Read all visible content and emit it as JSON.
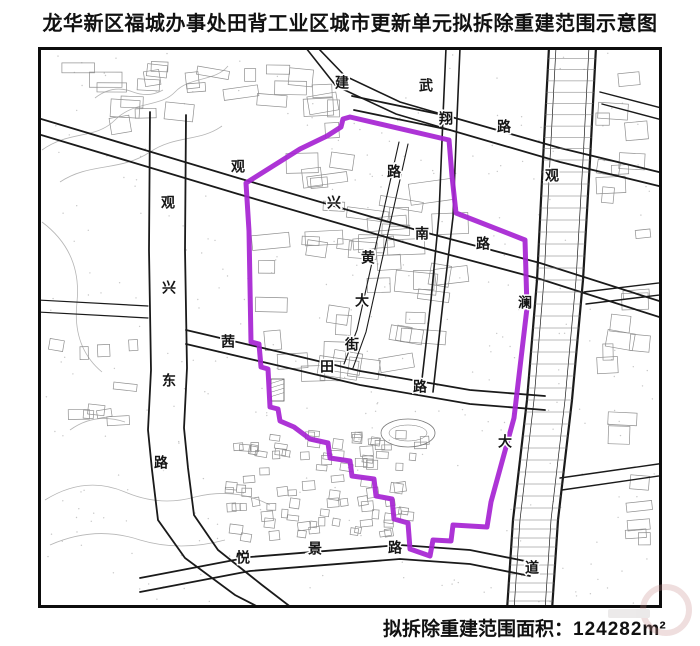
{
  "title": "龙华新区福城办事处田背工业区城市更新单元拟拆除重建范围示意图",
  "caption": {
    "label": "拟拆除重建范围面积：",
    "value": "124282",
    "unit": "m²"
  },
  "map": {
    "colors": {
      "ink": "#1a1a1a",
      "building": "#8f8f8f",
      "contour": "#b5b5b5",
      "speckle": "#9a9a9a",
      "boundary": "#a623d3"
    },
    "boundary_points": [
      [
        350,
        117
      ],
      [
        449,
        140
      ],
      [
        452,
        176
      ],
      [
        456,
        213
      ],
      [
        525,
        240
      ],
      [
        527,
        308
      ],
      [
        514,
        418
      ],
      [
        491,
        502
      ],
      [
        487,
        527
      ],
      [
        453,
        525
      ],
      [
        451,
        541
      ],
      [
        433,
        540
      ],
      [
        430,
        556
      ],
      [
        410,
        549
      ],
      [
        408,
        523
      ],
      [
        394,
        519
      ],
      [
        392,
        499
      ],
      [
        376,
        496
      ],
      [
        374,
        479
      ],
      [
        352,
        476
      ],
      [
        350,
        461
      ],
      [
        330,
        458
      ],
      [
        328,
        443
      ],
      [
        310,
        439
      ],
      [
        294,
        427
      ],
      [
        280,
        421
      ],
      [
        278,
        409
      ],
      [
        270,
        407
      ],
      [
        268,
        369
      ],
      [
        261,
        367
      ],
      [
        259,
        344
      ],
      [
        251,
        342
      ],
      [
        249,
        231
      ],
      [
        246,
        183
      ],
      [
        300,
        149
      ],
      [
        327,
        136
      ],
      [
        341,
        127
      ],
      [
        343,
        119
      ]
    ],
    "roads": [
      {
        "name": "guanxing-east-road",
        "w": 1.8,
        "lines": [
          [
            [
              150,
              112
            ],
            [
              149,
              250
            ],
            [
              151,
              370
            ],
            [
              148,
              430
            ],
            [
              152,
              470
            ],
            [
              158,
              520
            ],
            [
              185,
              558
            ],
            [
              235,
              595
            ],
            [
              268,
              612
            ]
          ],
          [
            [
              186,
              115
            ],
            [
              185,
              250
            ],
            [
              187,
              368
            ],
            [
              184,
              428
            ],
            [
              188,
              468
            ],
            [
              194,
              515
            ],
            [
              218,
              550
            ],
            [
              262,
              585
            ],
            [
              292,
              608
            ]
          ]
        ]
      },
      {
        "name": "guanxing-south-road",
        "w": 1.8,
        "lines": [
          [
            [
              38,
              118
            ],
            [
              238,
              178
            ],
            [
              420,
              231
            ],
            [
              540,
              263
            ],
            [
              700,
              314
            ]
          ],
          [
            [
              38,
              134
            ],
            [
              238,
              194
            ],
            [
              420,
              247
            ],
            [
              540,
              279
            ],
            [
              700,
              330
            ]
          ]
        ]
      },
      {
        "name": "wuxiang-road",
        "w": 1.8,
        "lines": [
          [
            [
              352,
              96
            ],
            [
              448,
              116
            ],
            [
              560,
              148
            ],
            [
              700,
              182
            ]
          ],
          [
            [
              354,
              110
            ],
            [
              450,
              130
            ],
            [
              560,
              162
            ],
            [
              700,
              196
            ]
          ]
        ]
      },
      {
        "name": "jian-road",
        "w": 1.6,
        "lines": [
          [
            [
              318,
              48
            ],
            [
              345,
              76
            ],
            [
              400,
              102
            ],
            [
              448,
              116
            ]
          ],
          [
            [
              306,
              48
            ],
            [
              336,
              86
            ],
            [
              396,
              114
            ],
            [
              450,
              130
            ]
          ]
        ]
      },
      {
        "name": "north-south-road",
        "w": 1.6,
        "lines": [
          [
            [
              446,
              48
            ],
            [
              443,
              116
            ],
            [
              439,
              215
            ],
            [
              431,
              300
            ],
            [
              421,
              388
            ]
          ],
          [
            [
              460,
              48
            ],
            [
              457,
              118
            ],
            [
              453,
              217
            ],
            [
              443,
              302
            ],
            [
              433,
              392
            ]
          ]
        ]
      },
      {
        "name": "huang-street",
        "w": 1.1,
        "lines": [
          [
            [
              399,
              142
            ],
            [
              377,
              240
            ],
            [
              357,
              330
            ],
            [
              344,
              364
            ]
          ],
          [
            [
              408,
              144
            ],
            [
              386,
              242
            ],
            [
              366,
              332
            ],
            [
              353,
              368
            ]
          ]
        ]
      },
      {
        "name": "qiantian-road",
        "w": 1.8,
        "lines": [
          [
            [
              186,
              330
            ],
            [
              280,
              352
            ],
            [
              360,
              371
            ],
            [
              470,
              390
            ],
            [
              545,
              396
            ]
          ],
          [
            [
              186,
              344
            ],
            [
              280,
              366
            ],
            [
              360,
              385
            ],
            [
              470,
              404
            ],
            [
              545,
              410
            ]
          ]
        ]
      },
      {
        "name": "guanlan-avenue",
        "w": 2.2,
        "hatch": true,
        "lines": [
          [
            [
              549,
              47
            ],
            [
              543,
              160
            ],
            [
              537,
              280
            ],
            [
              527,
              400
            ],
            [
              513,
              520
            ],
            [
              507,
              610
            ]
          ],
          [
            [
              596,
              47
            ],
            [
              590,
              160
            ],
            [
              583,
              280
            ],
            [
              572,
              400
            ],
            [
              558,
              520
            ],
            [
              552,
              610
            ]
          ],
          [
            [
              556,
              47
            ],
            [
              550,
              160
            ],
            [
              544,
              280
            ],
            [
              534,
              400
            ],
            [
              520,
              520
            ],
            [
              514,
              610
            ]
          ],
          [
            [
              589,
              47
            ],
            [
              583,
              160
            ],
            [
              576,
              280
            ],
            [
              565,
              400
            ],
            [
              551,
              520
            ],
            [
              545,
              610
            ]
          ]
        ]
      },
      {
        "name": "yuejing-road",
        "w": 1.8,
        "lines": [
          [
            [
              140,
              578
            ],
            [
              250,
              557
            ],
            [
              400,
              545
            ],
            [
              470,
              550
            ],
            [
              530,
              562
            ]
          ],
          [
            [
              140,
              592
            ],
            [
              250,
              571
            ],
            [
              400,
              559
            ],
            [
              470,
              564
            ],
            [
              530,
              576
            ]
          ]
        ]
      },
      {
        "name": "east-road-1",
        "w": 1.4,
        "lines": [
          [
            [
              600,
              92
            ],
            [
              700,
              118
            ]
          ],
          [
            [
              602,
              104
            ],
            [
              700,
              130
            ]
          ]
        ]
      },
      {
        "name": "east-road-2",
        "w": 1.4,
        "lines": [
          [
            [
              584,
              292
            ],
            [
              700,
              278
            ]
          ],
          [
            [
              586,
              304
            ],
            [
              700,
              290
            ]
          ]
        ]
      },
      {
        "name": "east-road-3",
        "w": 1.4,
        "lines": [
          [
            [
              560,
              478
            ],
            [
              700,
              458
            ]
          ],
          [
            [
              562,
              490
            ],
            [
              700,
              470
            ]
          ]
        ]
      },
      {
        "name": "west-road",
        "w": 1.2,
        "lines": [
          [
            [
              38,
              300
            ],
            [
              148,
              306
            ]
          ],
          [
            [
              38,
              312
            ],
            [
              148,
              318
            ]
          ]
        ]
      }
    ],
    "labels": [
      {
        "name": "观兴东路",
        "chars": [
          [
            "观",
            168,
            204
          ],
          [
            "兴",
            169,
            289
          ],
          [
            "东",
            169,
            382
          ],
          [
            "路",
            161,
            464
          ]
        ]
      },
      {
        "name": "观兴南路",
        "chars": [
          [
            "观",
            238,
            168
          ],
          [
            "兴",
            334,
            204
          ],
          [
            "南",
            422,
            235
          ],
          [
            "路",
            483,
            245
          ]
        ]
      },
      {
        "name": "武翔路",
        "chars": [
          [
            "武",
            426,
            87
          ],
          [
            "翔",
            446,
            120
          ],
          [
            "路",
            504,
            128
          ]
        ]
      },
      {
        "name": "建",
        "chars": [
          [
            "建",
            342,
            84
          ]
        ]
      },
      {
        "name": "路",
        "chars": [
          [
            "路",
            394,
            173
          ]
        ]
      },
      {
        "name": "黄大街",
        "chars": [
          [
            "黄",
            368,
            259
          ],
          [
            "大",
            362,
            302
          ],
          [
            "街",
            352,
            346
          ]
        ]
      },
      {
        "name": "茜田路",
        "chars": [
          [
            "茜",
            228,
            343
          ],
          [
            "田",
            327,
            368
          ],
          [
            "路",
            420,
            388
          ]
        ]
      },
      {
        "name": "观澜大道",
        "chars": [
          [
            "观",
            552,
            177
          ],
          [
            "澜",
            525,
            304
          ],
          [
            "大",
            505,
            443
          ],
          [
            "道",
            532,
            569
          ]
        ]
      },
      {
        "name": "悦景路",
        "chars": [
          [
            "悦",
            243,
            559
          ],
          [
            "景",
            315,
            550
          ],
          [
            "路",
            395,
            549
          ]
        ]
      }
    ],
    "sports_oval": {
      "cx": 408,
      "cy": 433,
      "rx": 27,
      "ry": 14
    },
    "hatched_building": {
      "x": 271,
      "y": 379,
      "w": 13,
      "h": 22
    }
  }
}
